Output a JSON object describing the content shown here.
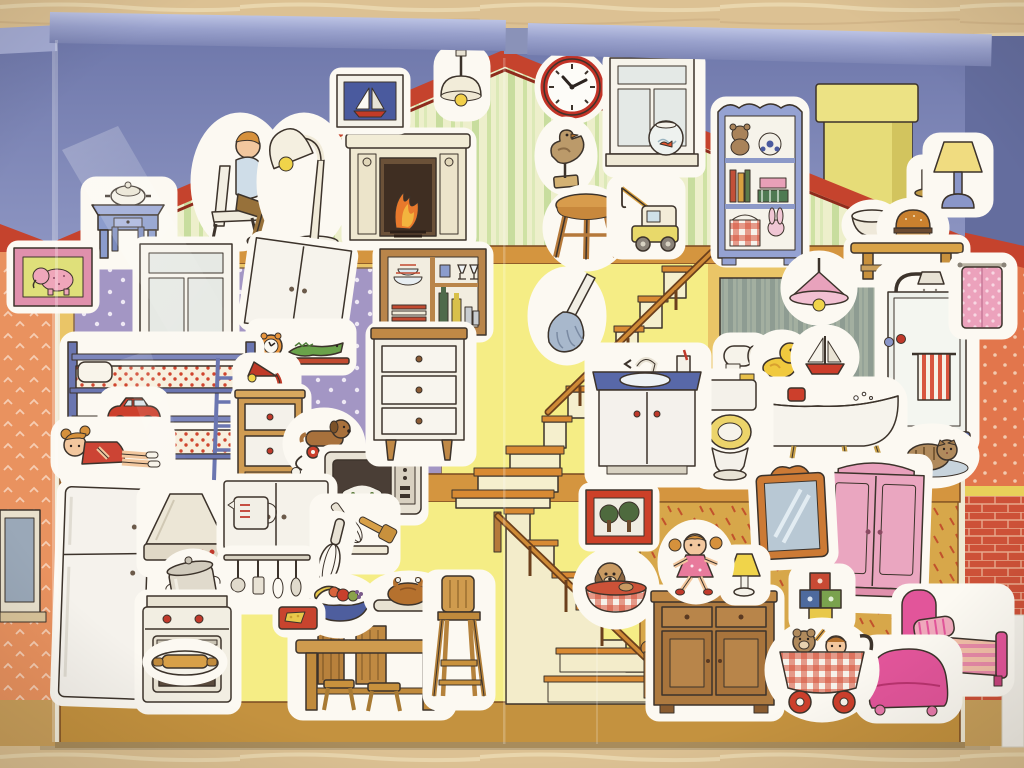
{
  "scene": {
    "subject": "Fold-out dollhouse sticker playset photographed on a wooden table",
    "board": "Two-panel hinged cardboard house with lavender plastic spines",
    "style": "children's watercolor illustration with white-bordered stickers"
  },
  "palette": {
    "wood": "#dcc193",
    "spine": "#9aa2cd",
    "spine_dark": "#7d85b4",
    "spine_light": "#bcc3e4",
    "sky": "#7780b3",
    "roof": "#c5432d",
    "roof_dark": "#8e2b1c",
    "attic_bg": "#edefcb",
    "floor_band": "#d4953f",
    "bottom_floor": "#c4923f",
    "wall_frame": "#eac567",
    "purple": "#a396c4",
    "yellow": "#f5ed85",
    "bath": "#a3afa0",
    "gold": "#d7a74a",
    "salmon": "#e9925f",
    "brick": "#cd5138",
    "ink": "#3c332b",
    "sticker": "#fcf9f2",
    "wood_furn": "#c8913d",
    "blue_furn": "#8b9ccc",
    "pink": "#e8a0bc",
    "hotpink": "#e2559a",
    "red": "#c83f2c",
    "cream": "#f2ecd9",
    "skin": "#f2c79e",
    "hair": "#d6913c",
    "toy_yellow": "#f0c93e"
  },
  "rooms": {
    "attic": "Attic with green striped wallpaper",
    "bedroom": "Children's bedroom with purple dotted wallpaper",
    "bathroom": "Bathroom with grey striped wall",
    "kitchen": "Yellow kitchen",
    "playroom": "Playroom with gold wallpaper",
    "staircase": "Switchback staircase",
    "chimney": "Yellow chimney",
    "exterior_left": "Salmon exterior wall with window",
    "exterior_right": "Orange and brick exterior wall"
  },
  "stickers": {
    "sailboat_picture": "Sailboat picture",
    "pendant_lamp": "Ceiling pendant lamp",
    "wall_clock": "Red wall clock",
    "attic_window": "Window with fishbowl",
    "reading_man": "Man sitting on chair",
    "floor_lamp": "Floor lamp",
    "fireplace": "Fireplace with fire",
    "blue_table": "Blue side table with tureen",
    "duck_figurine": "Duck figurine",
    "stool": "Wooden stool",
    "toy_crane": "Toy crane truck",
    "bookshelf": "Toy shelf with teddy and football",
    "candle": "Candlestick",
    "flap_lamp": "Bedside lamp",
    "bowl": "Bowl",
    "burger": "Burger on plate",
    "bench": "Wooden bench",
    "elephant_picture": "Elephant picture",
    "bedroom_window": "Bedroom window",
    "white_cabinet": "White wall cabinet",
    "shelf_clock_croc": "Shelf with alarm clock and toy crocodile",
    "bunk_bed": "Blue bunk bed",
    "toy_car": "Red toy car",
    "lying_girl": "Girl lying on lower bunk",
    "desk_lamp": "Red desk lamp",
    "nightstand": "Nightstand",
    "dachshund_toy": "Pull-along dachshund",
    "microwave": "Microwave oven",
    "dish_cabinet": "Dish cabinet with crockery",
    "drawer_chest": "Chest of drawers",
    "feather_duster": "Feather duster",
    "sink_vanity": "Bathroom sink vanity",
    "tree_picture": "Picture with trees",
    "puppy_basket": "Puppy in basket",
    "bath_lamp": "Pink ceiling lamp",
    "toilet_paper": "Toilet paper roll",
    "rubber_duck": "Rubber duck",
    "toy_sailboat": "Toy sailboat",
    "toilet": "Toilet with open lid",
    "bathtub": "Clawfoot bathtub",
    "shower": "Shower cabin with striped towel",
    "pink_towel": "Pink towel on hook",
    "cat": "Cat on rug",
    "fridge": "Refrigerator",
    "extractor_hood": "Extractor hood",
    "cooking_pot": "Cooking pot",
    "stove": "Kitchen stove",
    "rolling_pin": "Rolling pin on platter",
    "kitchen_cabinet": "Kitchen wall cabinet",
    "measuring_jug": "Measuring jug",
    "whisk": "Whisk",
    "utensil_rack": "Hanging utensil rack",
    "utensil_shelf": "Shelf with whisk and spatula",
    "fruit_bowl": "Fruit bowl",
    "cutting_board": "Cutting board with cheese",
    "kitchen_table": "Kitchen table with chairs",
    "roast_chicken": "Roast chicken on tray",
    "high_chair": "High chair",
    "mirror": "Wall mirror",
    "standing_girl": "Girl doll",
    "small_lamp": "Small table lamp",
    "sideboard": "Wooden sideboard",
    "blocks": "Building blocks",
    "wardrobe": "Pink wardrobe",
    "pram": "Toy pram with teddy and doll",
    "armchair": "Pink armchair",
    "bed": "Pink bed"
  }
}
